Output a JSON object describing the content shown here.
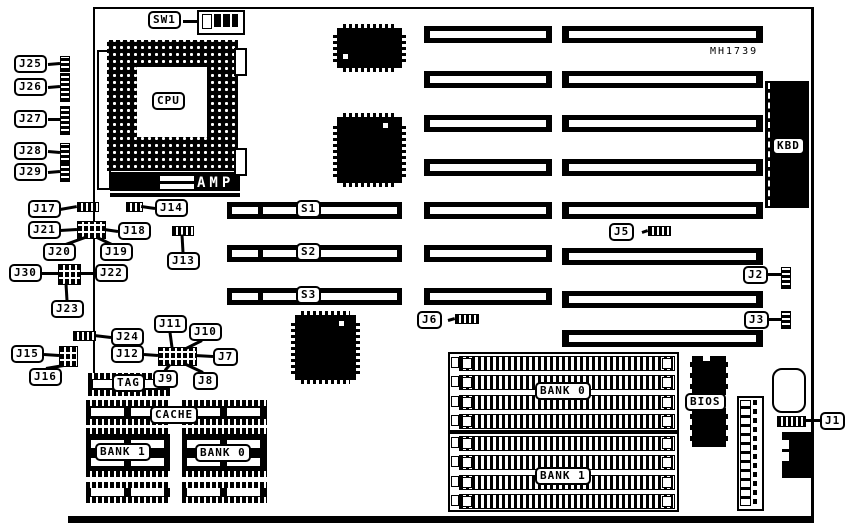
{
  "diagram": {
    "kind": "motherboard-layout-diagram",
    "part_number": "MH1739",
    "ink": "#000000",
    "paper": "#ffffff"
  },
  "callouts": {
    "sw1": "SW1",
    "j1": "J1",
    "j2": "J2",
    "j3": "J3",
    "j5": "J5",
    "j6": "J6",
    "j7": "J7",
    "j8": "J8",
    "j9": "J9",
    "j10": "J10",
    "j11": "J11",
    "j12": "J12",
    "j13": "J13",
    "j14": "J14",
    "j15": "J15",
    "j16": "J16",
    "j17": "J17",
    "j18": "J18",
    "j19": "J19",
    "j20": "J20",
    "j21": "J21",
    "j22": "J22",
    "j23": "J23",
    "j24": "J24",
    "j25": "J25",
    "j26": "J26",
    "j27": "J27",
    "j28": "J28",
    "j29": "J29",
    "j30": "J30",
    "s1": "S1",
    "s2": "S2",
    "s3": "S3"
  },
  "labels": {
    "cpu": "CPU",
    "amp": "AMP",
    "kbd": "KBD",
    "tag": "TAG",
    "cache": "CACHE",
    "cache_bank1": "BANK 1",
    "cache_bank0": "BANK 0",
    "simm_bank0": "BANK 0",
    "simm_bank1": "BANK 1",
    "bios": "BIOS"
  },
  "structure": {
    "expansion_slots_left_column": 7,
    "expansion_slots_right_column": 8,
    "sipp_slot_labels": [
      "S1",
      "S2",
      "S3"
    ],
    "simm_sockets_per_bank": 4,
    "dip_switch_positions": 4
  }
}
